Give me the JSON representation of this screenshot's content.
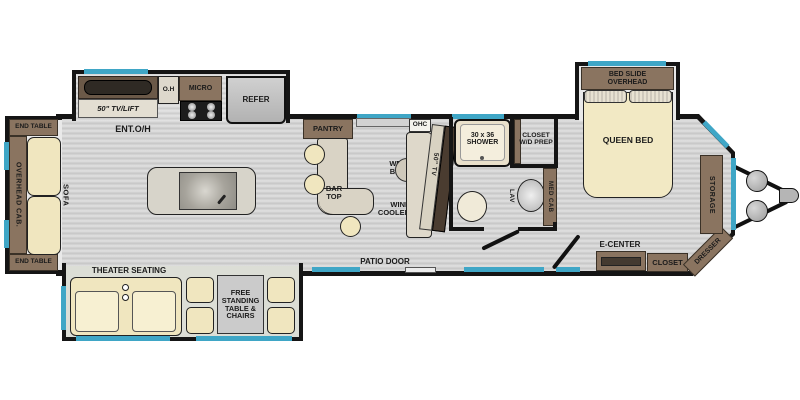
{
  "title": "Travel trailer floor plan",
  "colors": {
    "wall": "#151515",
    "window": "#3fa6c6",
    "floor": "#d2d2d2",
    "cabinet": "#8a7460",
    "cabinet-dark": "#6b5948",
    "beige": "#f0e6bf",
    "appliance": "#c2c2c2",
    "counter": "#d9d3c5",
    "showerc": "#e9e0cb"
  },
  "labels": {
    "end_table": "END TABLE",
    "overhead_cab": "OVERHEAD CAB.",
    "sofa": "SOFA",
    "tv_lift": "50\" TV/LIFT",
    "ent_oh": "ENT.O/H",
    "oh": "O.H",
    "micro": "MICRO",
    "refer": "REFER",
    "pantry": "PANTRY",
    "bar_l1": "BAR",
    "bar_l2": "TOP",
    "wet_l1": "WET",
    "wet_l2": "BAR",
    "wine_l1": "WINE",
    "wine_l2": "COOLER",
    "ohc": "OHC",
    "tv50": "50\" TV",
    "shower_l1": "30 x 36",
    "shower_l2": "SHOWER",
    "closetwd_l1": "CLOSET",
    "closetwd_l2": "W/D PREP",
    "lav": "LAV",
    "med_cab": "MED CAB",
    "queen_bed": "QUEEN BED",
    "bedslide_l1": "BED SLIDE",
    "bedslide_l2": "OVERHEAD",
    "storage": "STORAGE",
    "dresser": "DRESSER",
    "e_center": "E-CENTER",
    "closet": "CLOSET",
    "patio_door": "PATIO DOOR",
    "theater": "THEATER SEATING",
    "fs_l1": "FREE",
    "fs_l2": "STANDING",
    "fs_l3": "TABLE &",
    "fs_l4": "CHAIRS"
  }
}
